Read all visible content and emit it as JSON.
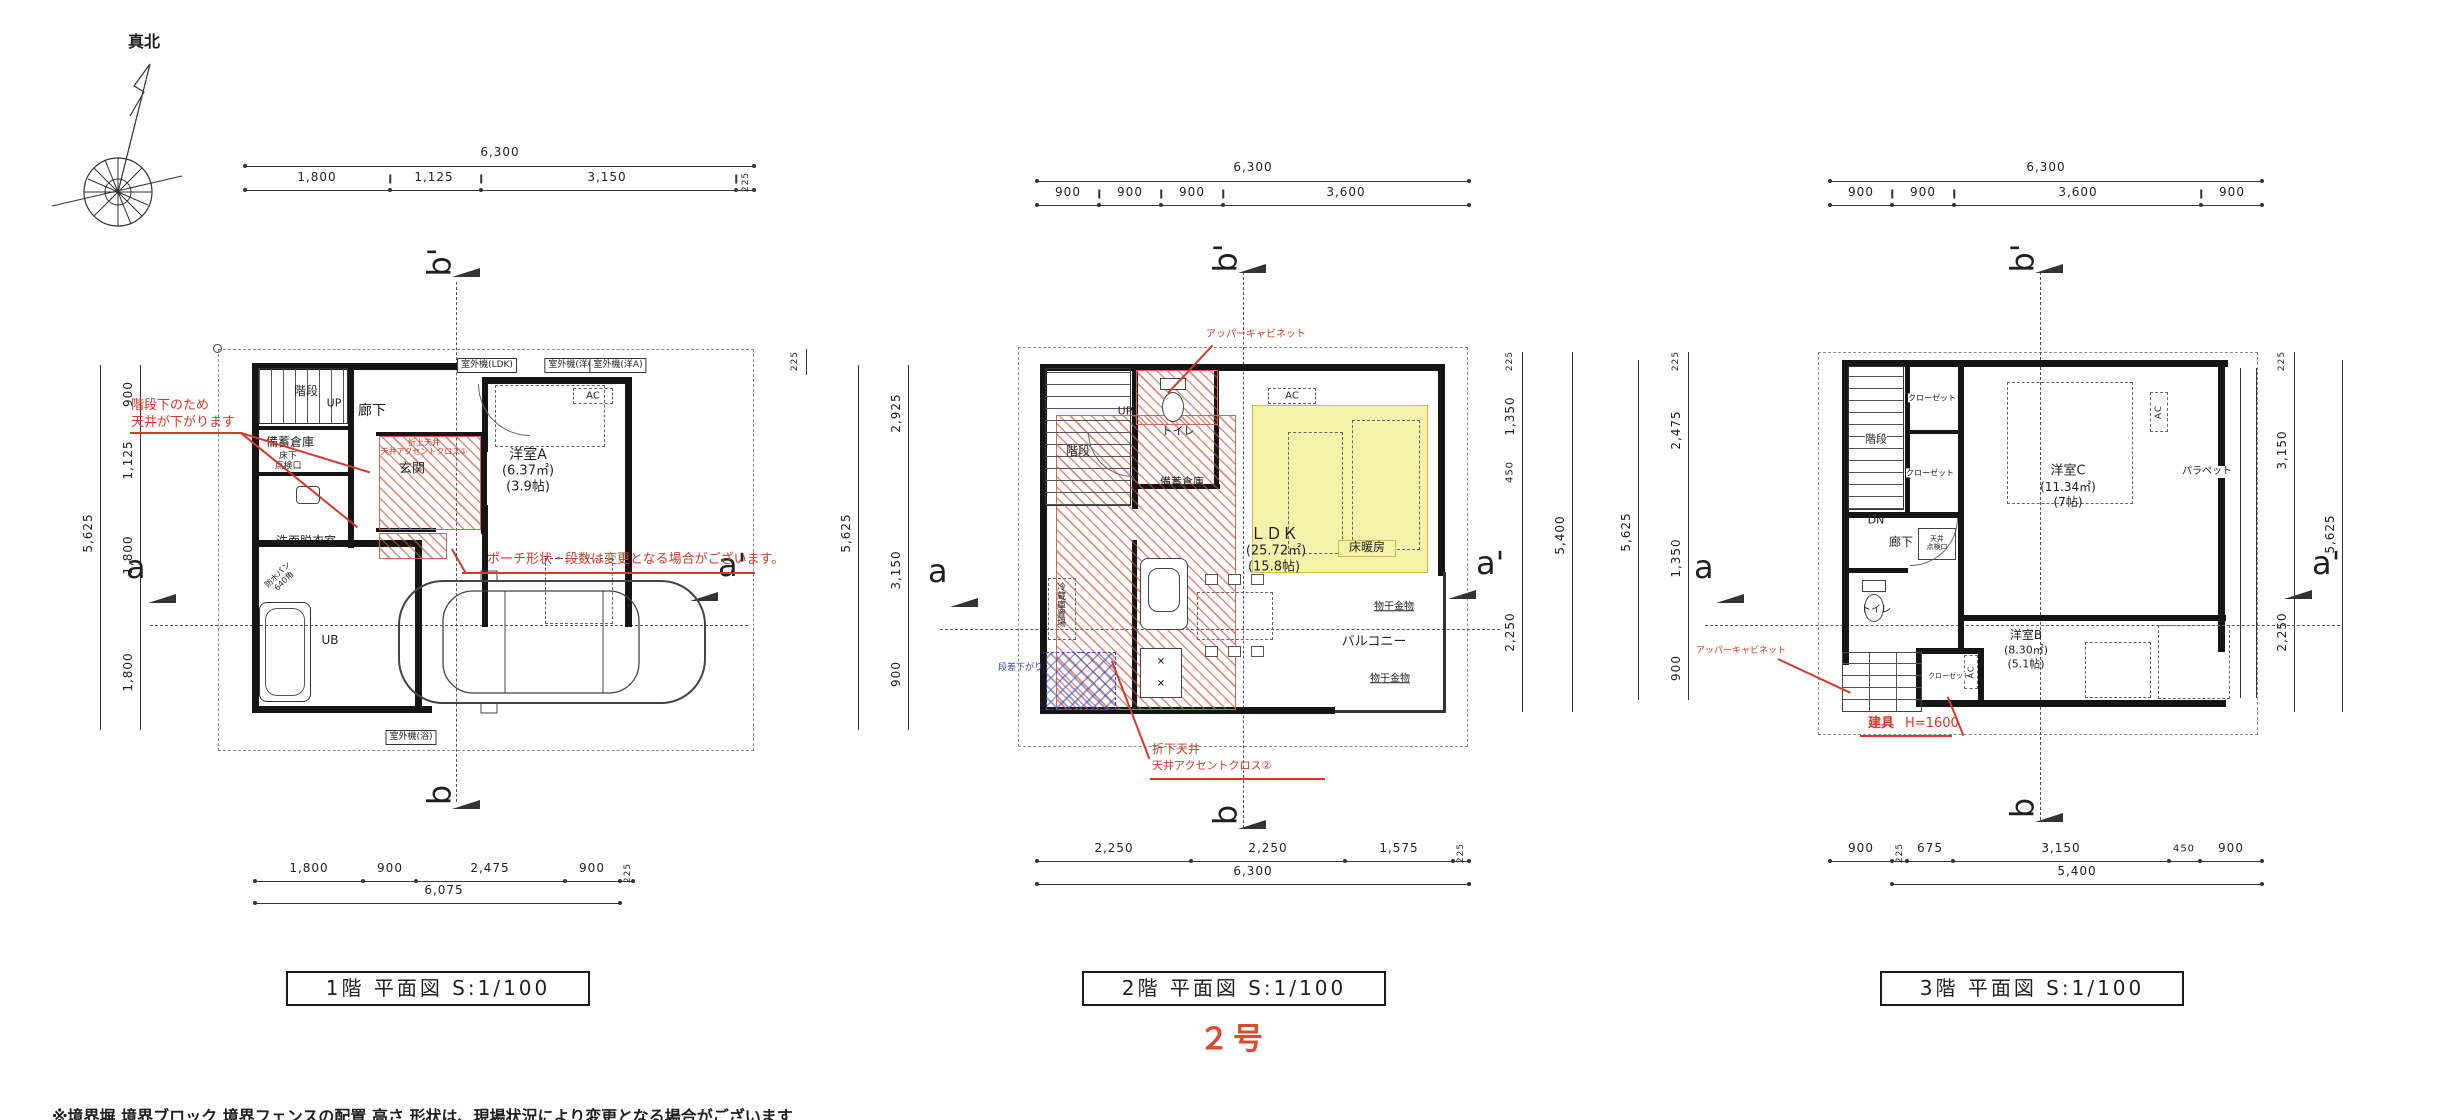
{
  "page": {
    "north_label": "真北",
    "unit_label": "２号",
    "footer_note": "※境界塀 境界ブロック 境界フェンスの配置 高さ 形状は、現場状況により変更となる場合がございます"
  },
  "colors": {
    "line": "#1f1f1f",
    "annotation_red": "#d5392b",
    "heated_floor_yellow": "#f6f2a9",
    "accent_blue": "#3847b0",
    "unit_red": "#e04a2a"
  },
  "captions": {
    "floor1": "1階  平面図 S:1/100",
    "floor2": "2階  平面図 S:1/100",
    "floor3": "3階  平面図 S:1/100"
  },
  "sections": {
    "a": "a",
    "a_prime": "a'",
    "b": "b",
    "b_prime": "b'"
  },
  "floor1": {
    "dims": {
      "top_overall": "6,300",
      "top_segments": [
        "1,800",
        "1,125",
        "3,150",
        "225"
      ],
      "bottom_segments": [
        "1,800",
        "900",
        "2,475",
        "900",
        "225"
      ],
      "bottom_overall": "6,075",
      "left_overall": "5,625",
      "left_segments": [
        "900",
        "1,125",
        "1,800",
        "1,800"
      ],
      "right_top": "225",
      "right_overall": "5,625"
    },
    "rooms": {
      "stairs": "階段",
      "up": "UP",
      "hallway": "廊下",
      "storage": "備蓄倉庫",
      "floor_hatch_l1": "床下",
      "floor_hatch_l2": "点検口",
      "entrance": "玄関",
      "washroom": "洗面脱衣室",
      "pan_l1": "防水パン",
      "pan_l2": "640角",
      "bath": "UB",
      "room_a": "洋室A",
      "room_a_area": "(6.37㎡)",
      "room_a_tatami": "(3.9帖)",
      "ac": "AC"
    },
    "equipment": {
      "outdoor_unit_ldk": "室外機(LDK)",
      "outdoor_unit_c": "室外機(洋C)",
      "outdoor_unit_a": "室外機(洋A)",
      "outdoor_unit_bath": "室外機(浴)"
    },
    "annotations": {
      "under_stairs_l1": "階段下のため",
      "under_stairs_l2": "天井が下がります",
      "porch_note": "ポーチ形状・段数は変更となる場合がございます。",
      "ceiling_l1": "折上天井",
      "ceiling_l2": "天井アクセントクロス①"
    }
  },
  "floor2": {
    "dims": {
      "top_overall": "6,300",
      "top_segments": [
        "900",
        "900",
        "900",
        "3,600"
      ],
      "bottom_segments": [
        "2,250",
        "2,250",
        "1,575",
        "225"
      ],
      "bottom_overall": "6,300",
      "left_segments": [
        "2,925",
        "3,150",
        "900"
      ],
      "right_top": "225",
      "right_segments": [
        "1,350",
        "450",
        "2,250"
      ],
      "right_overall": "5,400"
    },
    "rooms": {
      "stairs": "階段",
      "up": "UP",
      "toilet": "トイレ",
      "storage": "備蓄倉庫",
      "ldk": "ＬＤＫ",
      "ldk_area": "(25.72㎡)",
      "ldk_tatami": "(15.8帖)",
      "floor_heating": "床暖房",
      "balcony": "バルコニー",
      "laundry_hook": "物干金物",
      "ac": "AC",
      "fridge": "冷蔵庫置場"
    },
    "annotations": {
      "upper_cabinet": "アッパーキャビネット",
      "ceiling_l1": "折下天井",
      "ceiling_l2": "天井アクセントクロス②",
      "step_down": "段差下がり"
    }
  },
  "floor3": {
    "dims": {
      "top_overall": "6,300",
      "top_segments": [
        "900",
        "900",
        "3,600",
        "900"
      ],
      "bottom_segments": [
        "900",
        "225",
        "675",
        "3,150",
        "450",
        "900"
      ],
      "bottom_overall": "5,400",
      "left_top": "225",
      "left_overall": "5,625",
      "left_segments": [
        "2,475",
        "1,350",
        "900"
      ],
      "right_top": "225",
      "right_segments": [
        "3,150",
        "2,250"
      ],
      "right_overall": "5,625"
    },
    "rooms": {
      "stairs": "階段",
      "dn": "DN",
      "closet_upper": "クローゼット",
      "closet_lower": "クローゼット",
      "hallway": "廊下",
      "hatch_l1": "天井",
      "hatch_l2": "点検口",
      "room_c": "洋室C",
      "room_c_area": "(11.34㎡)",
      "room_c_tatami": "(7帖)",
      "parapet": "パラペット",
      "toilet": "トイレ",
      "room_b": "洋室B",
      "room_b_area": "(8.30㎡)",
      "room_b_tatami": "(5.1帖)",
      "closet_bottom": "クローゼット",
      "ac": "AC"
    },
    "annotations": {
      "upper_cabinet": "アッパーキャビネット",
      "fitting": "建具",
      "fitting_height": "H=1600"
    }
  }
}
